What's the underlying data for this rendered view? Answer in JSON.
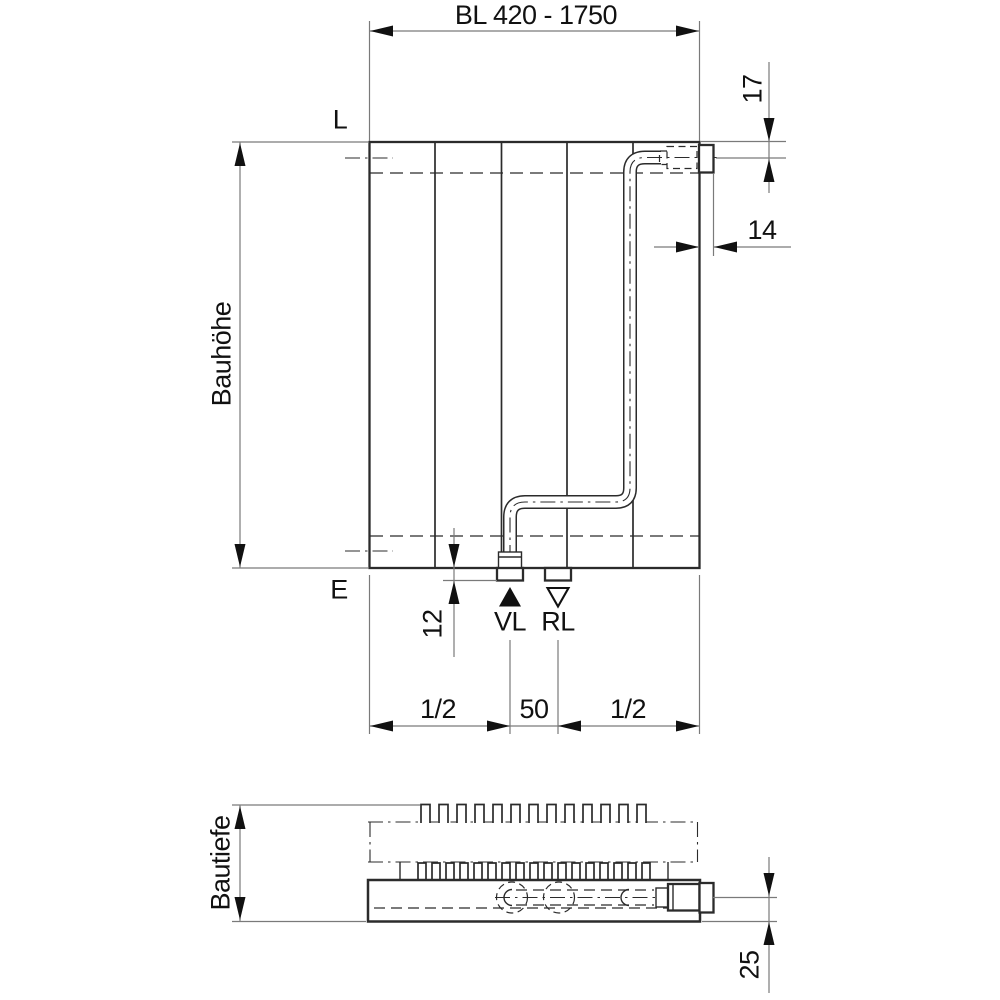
{
  "drawing": {
    "front_view": {
      "width_dim": "BL 420 - 1750",
      "top_inlet_offset_dim": "17",
      "side_inlet_offset_dim": "14",
      "height_dim": "Bauhöhe",
      "vent_label": "L",
      "drain_label": "E",
      "stub_height_dim": "12",
      "supply_label": "VL",
      "return_label": "RL",
      "half_left_dim": "1/2",
      "center_spacing_dim": "50",
      "half_right_dim": "1/2"
    },
    "top_view": {
      "depth_dim": "Bautiefe",
      "pipe_axis_offset_dim": "25"
    },
    "colors": {
      "line": "#2b2b2b",
      "dim_line": "#7a7a7a",
      "text": "#111111",
      "background": "#ffffff"
    }
  }
}
